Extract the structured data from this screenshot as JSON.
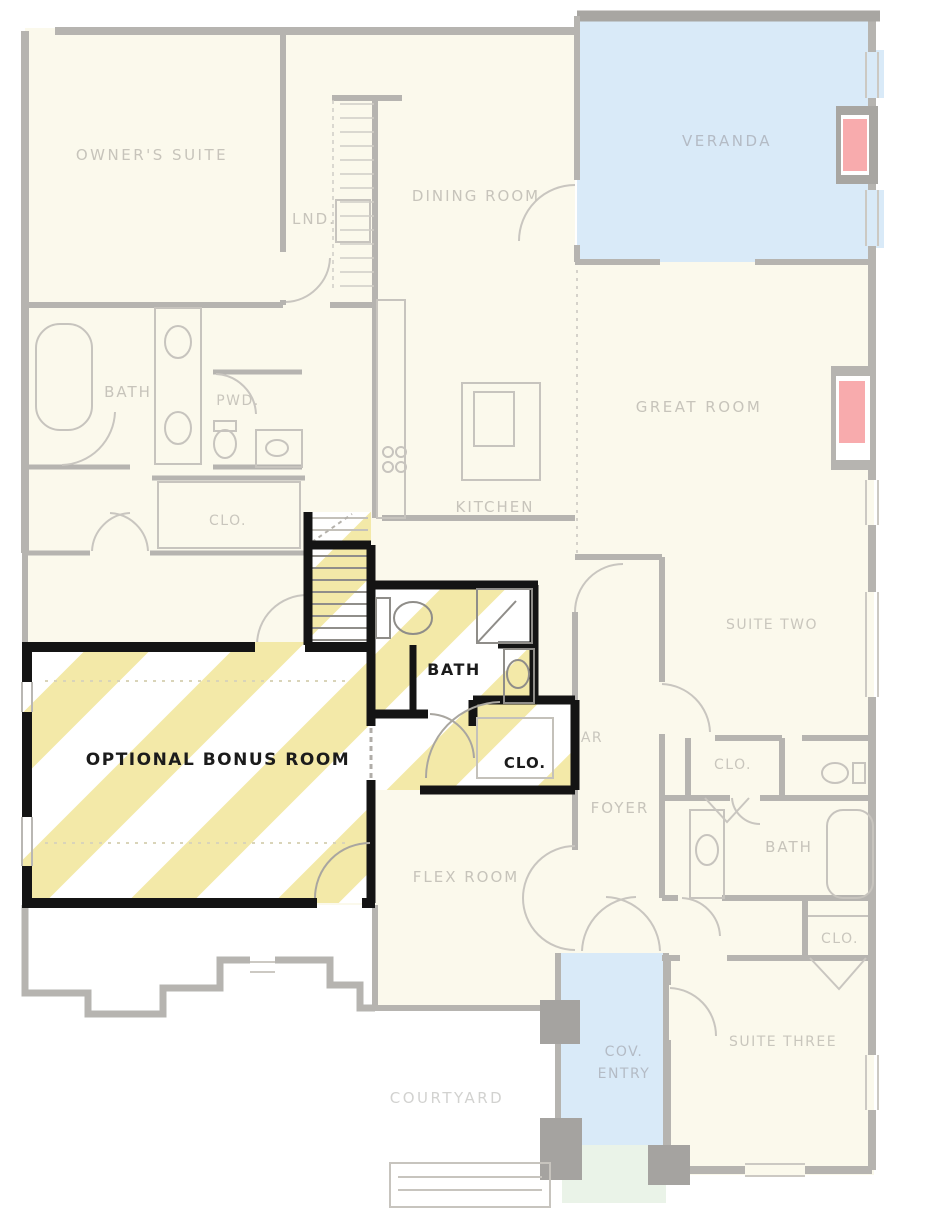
{
  "rooms": {
    "owners_suite": {
      "label": "OWNER'S SUITE"
    },
    "laundry": {
      "label": "LND."
    },
    "dining_room": {
      "label": "DINING ROOM"
    },
    "veranda": {
      "label": "VERANDA"
    },
    "owners_bath": {
      "label": "BATH"
    },
    "powder": {
      "label": "PWD."
    },
    "owners_closet": {
      "label": "CLO."
    },
    "kitchen": {
      "label": "KITCHEN"
    },
    "great_room": {
      "label": "GREAT ROOM"
    },
    "suite_two": {
      "label": "SUITE TWO"
    },
    "suite_two_closet": {
      "label": "CLO."
    },
    "suite_two_bath": {
      "label": "BATH"
    },
    "hall_closet": {
      "label": "CLO."
    },
    "foyer": {
      "label": "FOYER"
    },
    "partial_ar": {
      "label": "AR"
    },
    "flex_room": {
      "label": "FLEX ROOM"
    },
    "suite_three": {
      "label": "SUITE THREE"
    },
    "covered_entry": {
      "label_line1": "COV.",
      "label_line2": "ENTRY"
    },
    "courtyard": {
      "label": "COURTYARD"
    },
    "bonus_room": {
      "label": "OPTIONAL BONUS ROOM"
    },
    "bonus_bath": {
      "label": "BATH"
    },
    "bonus_closet": {
      "label": "CLO."
    }
  },
  "colors": {
    "highlight_stripe": "#f3e9a8",
    "stripe_bg": "#ffffff",
    "veranda_blue": "#d9eaf8",
    "entry_blue": "#d9eaf8",
    "fireplace_pink": "#f8abad",
    "wall_gray": "#b6b4b0",
    "bold_wall": "#141414",
    "plan_cream": "#fbf9ec",
    "faded_text": "#c7c4bb",
    "steps_green": "#eaf3e8"
  }
}
